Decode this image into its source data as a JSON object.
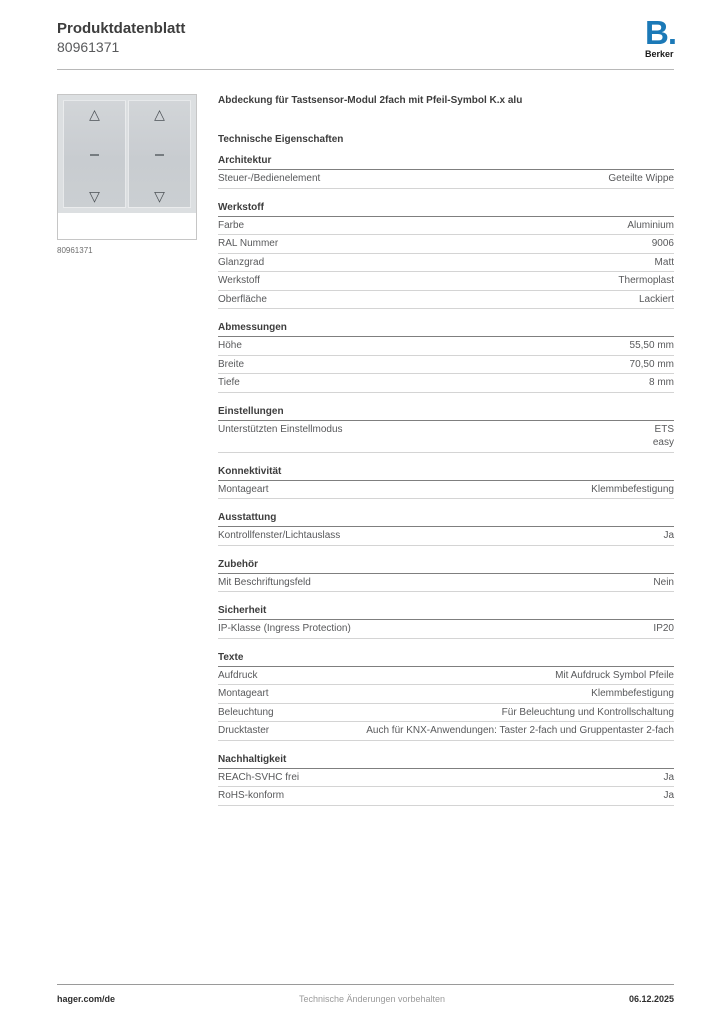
{
  "header": {
    "title": "Produktdatenblatt",
    "product_number": "80961371",
    "logo": {
      "mark": "B.",
      "name": "Berker",
      "color": "#1b79b7"
    }
  },
  "product": {
    "image_caption": "80961371",
    "title": "Abdeckung für Tastsensor-Modul 2fach mit Pfeil-Symbol K.x alu",
    "tech_properties_title": "Technische Eigenschaften",
    "rocker_symbols": [
      "arrow-up",
      "dash",
      "arrow-down"
    ],
    "arrow_up_glyph": "△",
    "arrow_down_glyph": "▽"
  },
  "sections": [
    {
      "title": "Architektur",
      "rows": [
        {
          "label": "Steuer-/Bedienelement",
          "value": "Geteilte Wippe"
        }
      ]
    },
    {
      "title": "Werkstoff",
      "rows": [
        {
          "label": "Farbe",
          "value": "Aluminium"
        },
        {
          "label": "RAL Nummer",
          "value": "9006"
        },
        {
          "label": "Glanzgrad",
          "value": "Matt"
        },
        {
          "label": "Werkstoff",
          "value": "Thermoplast"
        },
        {
          "label": "Oberfläche",
          "value": "Lackiert"
        }
      ]
    },
    {
      "title": "Abmessungen",
      "rows": [
        {
          "label": "Höhe",
          "value": "55,50 mm"
        },
        {
          "label": "Breite",
          "value": "70,50 mm"
        },
        {
          "label": "Tiefe",
          "value": "8 mm"
        }
      ]
    },
    {
      "title": "Einstellungen",
      "rows": [
        {
          "label": "Unterstützten Einstellmodus",
          "value": "ETS\neasy"
        }
      ]
    },
    {
      "title": "Konnektivität",
      "rows": [
        {
          "label": "Montageart",
          "value": "Klemmbefestigung"
        }
      ]
    },
    {
      "title": "Ausstattung",
      "rows": [
        {
          "label": "Kontrollfenster/Lichtauslass",
          "value": "Ja"
        }
      ]
    },
    {
      "title": "Zubehör",
      "rows": [
        {
          "label": "Mit Beschriftungsfeld",
          "value": "Nein"
        }
      ]
    },
    {
      "title": "Sicherheit",
      "rows": [
        {
          "label": "IP-Klasse (Ingress Protection)",
          "value": "IP20"
        }
      ]
    },
    {
      "title": "Texte",
      "rows": [
        {
          "label": "Aufdruck",
          "value": "Mit Aufdruck Symbol Pfeile"
        },
        {
          "label": "Montageart",
          "value": "Klemmbefestigung"
        },
        {
          "label": "Beleuchtung",
          "value": "Für Beleuchtung und Kontrollschaltung"
        },
        {
          "label": "Drucktaster",
          "value": "Auch für KNX-Anwendungen: Taster 2-fach und Gruppentaster 2-fach"
        }
      ]
    },
    {
      "title": "Nachhaltigkeit",
      "rows": [
        {
          "label": "REACh-SVHC frei",
          "value": "Ja"
        },
        {
          "label": "RoHS-konform",
          "value": "Ja"
        }
      ]
    }
  ],
  "footer": {
    "website": "hager.com/de",
    "note": "Technische Änderungen vorbehalten",
    "date": "06.12.2025"
  }
}
